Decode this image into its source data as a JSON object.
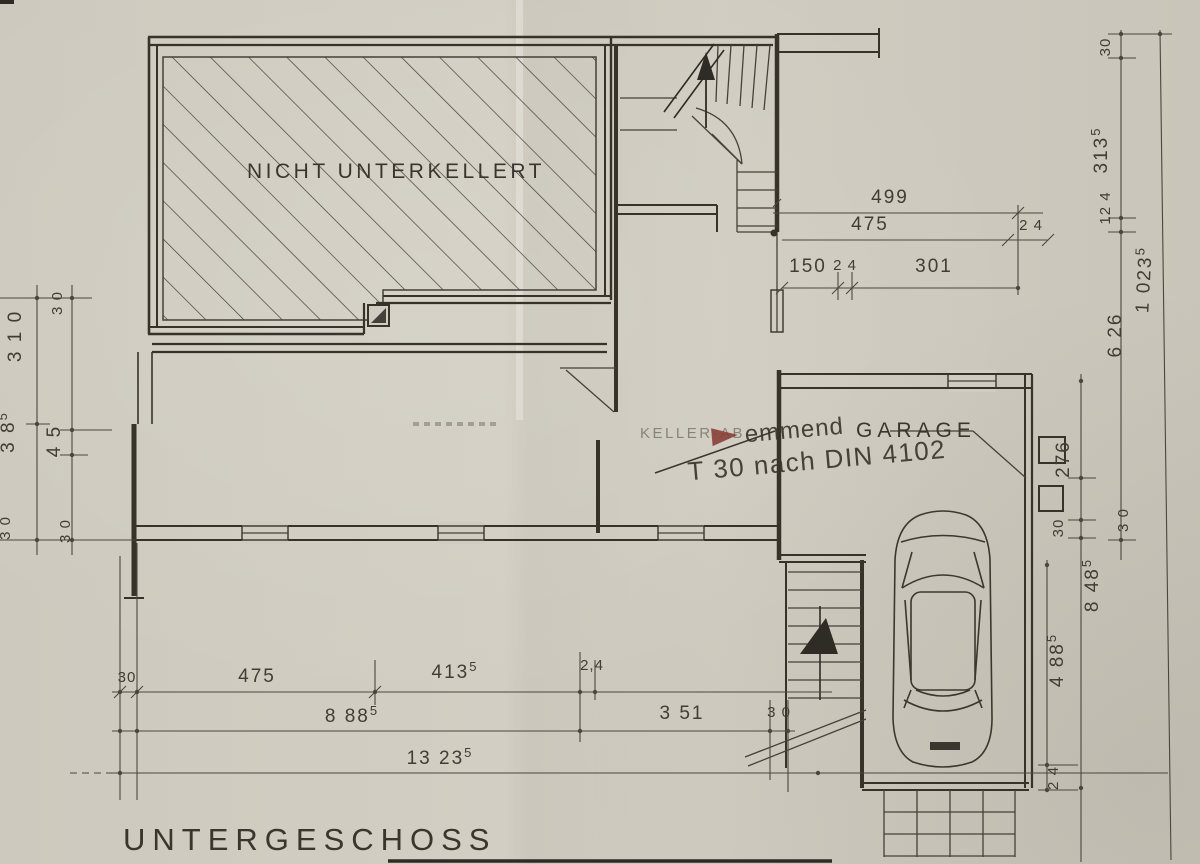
{
  "title": "UNTERGESCHOSS",
  "labels": {
    "not_basemented": "NICHT UNTERKELLERT",
    "garage": "GARAGE",
    "keller_faint": "KELLER-AB"
  },
  "stamp": {
    "line1": "emmend",
    "line2": "T 30 nach DIN 4102",
    "color": "#b5463c"
  },
  "dims": {
    "top": {
      "d499": "499",
      "d475": "475",
      "d24a": "2 4",
      "d150": "150",
      "d24b": "2 4",
      "d301": "301"
    },
    "right": {
      "d30": "30",
      "d3135_main": "313",
      "d3135_sup": "5",
      "d124": "12 4",
      "d626": "6 26",
      "d10235_main": "1 023",
      "d10235_sup": "5",
      "d276": "276",
      "d30b": "30",
      "d8485_main": "8 48",
      "d8485_sup": "5",
      "d30c": "3 0",
      "d4885_main": "4 88",
      "d4885_sup": "5",
      "d24": "2 4"
    },
    "left": {
      "d30a": "3 0",
      "d310": "3 1 0",
      "d385_main": "3 8",
      "d385_sup": "5",
      "d45": "4 5",
      "d30b": "3 0",
      "d30c": "3 0"
    },
    "bottom": {
      "d30a": "30",
      "d475": "475",
      "d4135_main": "413",
      "d4135_sup": "5",
      "d24": "2,4",
      "d8885_main": "8 88",
      "d8885_sup": "5",
      "d351": "3 51",
      "d30b": "3 0",
      "d13235_main": "13 23",
      "d13235_sup": "5"
    }
  }
}
